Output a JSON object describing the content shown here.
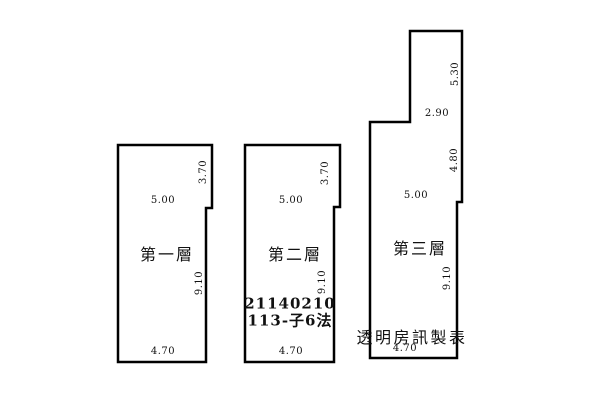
{
  "floors": [
    {
      "label": "第一層",
      "dim_top": "5.00",
      "dim_upper_right": "3.70",
      "dim_right": "9.10",
      "dim_bottom": "4.70"
    },
    {
      "label": "第二層",
      "dim_top": "5.00",
      "dim_upper_right": "3.70",
      "dim_right": "9.10",
      "dim_bottom": "4.70",
      "case_number": "21140210",
      "case_code": "113-子6法"
    },
    {
      "label": "第三層",
      "dim_upper_right": "5.30",
      "dim_notch": "2.90",
      "dim_mid_right": "4.80",
      "dim_top": "5.00",
      "dim_right": "9.10",
      "dim_bottom": "4.70"
    }
  ],
  "watermark": "透明房訊製表",
  "colors": {
    "line": "#000000",
    "background": "#ffffff",
    "text": "#111111"
  }
}
